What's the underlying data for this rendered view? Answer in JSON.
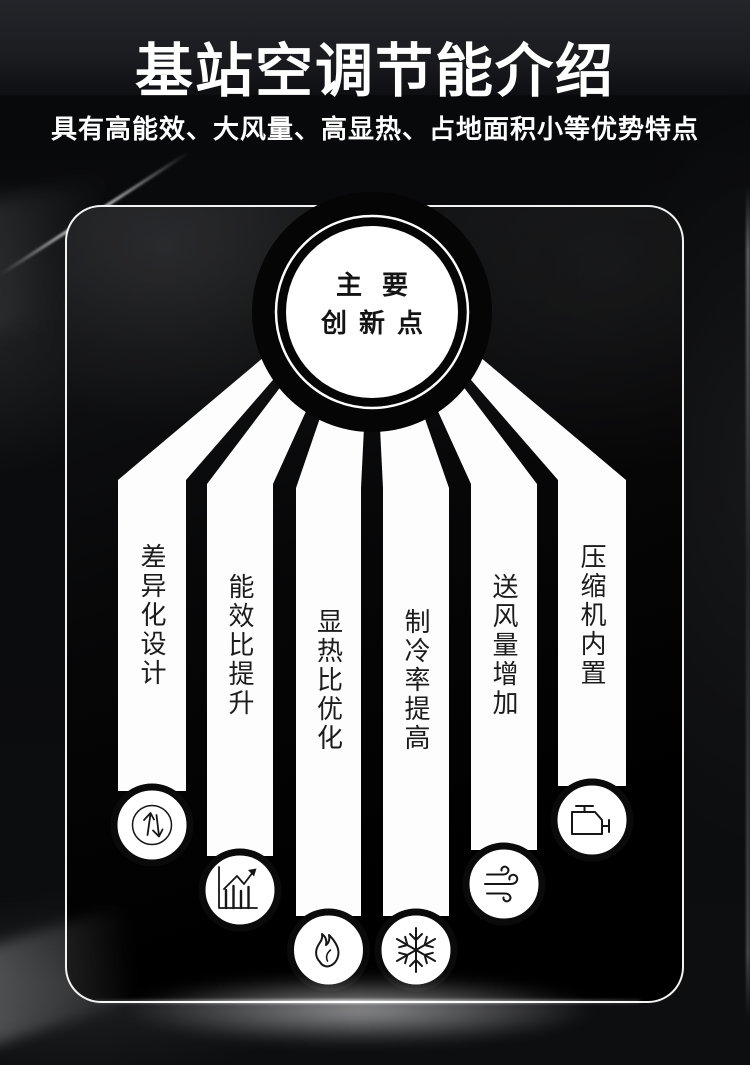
{
  "header": {
    "title": "基站空调节能介绍",
    "subtitle": "具有高能效、大风量、高显热、占地面积小等优势特点"
  },
  "diagram": {
    "center_circle": {
      "line1": "主要",
      "line2": "创新点"
    },
    "items": [
      {
        "label": "差异化设计",
        "icon": "updown-arrows-icon"
      },
      {
        "label": "能效比提升",
        "icon": "bar-chart-rise-icon"
      },
      {
        "label": "显热比优化",
        "icon": "flame-icon"
      },
      {
        "label": "制冷率提高",
        "icon": "snowflake-icon"
      },
      {
        "label": "送风量增加",
        "icon": "wind-icon"
      },
      {
        "label": "压缩机内置",
        "icon": "engine-icon"
      }
    ]
  },
  "colors": {
    "background": "#0a0b0d",
    "panel_border": "#ffffff",
    "ribbon": "#ffffff",
    "label_text": "#1c1c1c",
    "title_text": "#ffffff"
  }
}
